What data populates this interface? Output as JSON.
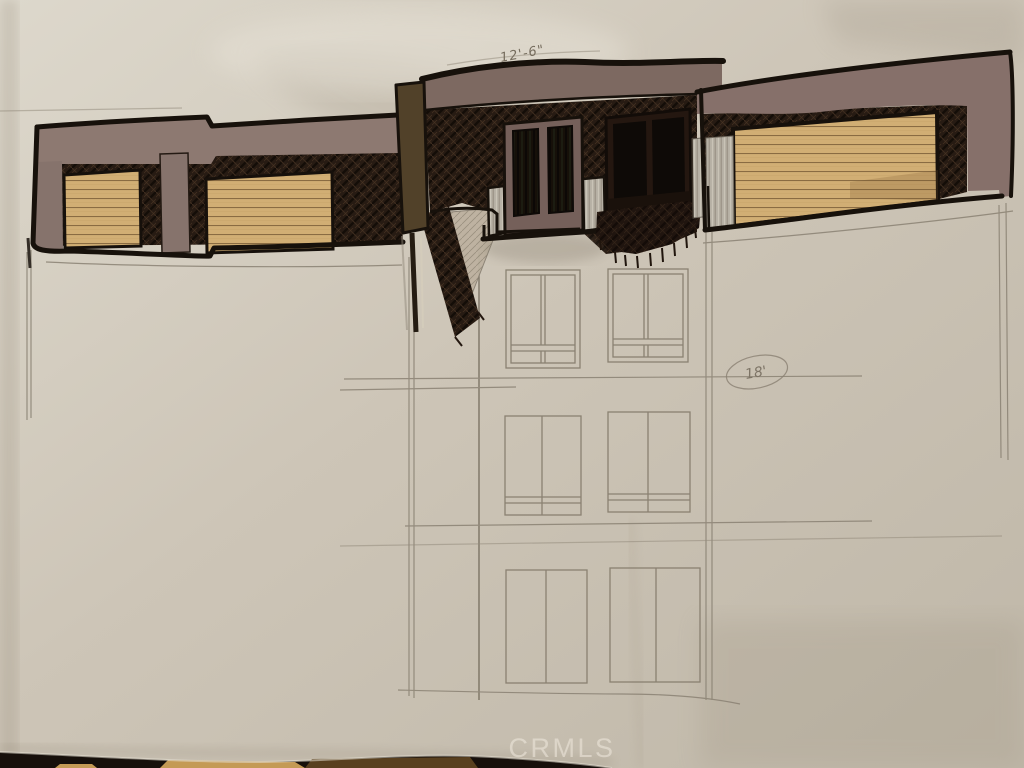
{
  "scene": {
    "label": "architectural elevation sketch",
    "description": "Photograph of a hand-drawn, marker-colored front elevation sketch of a modern house on creased paper; lower floors only pencil-lined"
  },
  "annotations": {
    "roof_dimension": "12'-6\"",
    "circled_dimension": "18'"
  },
  "watermark": {
    "text": "CRMLS"
  },
  "colors": {
    "paper": "#cdc5b7",
    "ink_outline": "#17110b",
    "hatch_dark_brown": "#271b13",
    "mauve_band": "#86736c",
    "fascia_mauve": "#7d6961",
    "tan_siding": "#d1ae74",
    "olive_pillar": "#514129",
    "door_frame_mauve": "#75605a",
    "glass_dark": "#120d09",
    "silver_gray": "#b6b0a4",
    "pencil_gray": "#8a8173",
    "watermark_white": "#f0eade",
    "table_dark": "#17100b",
    "table_tan": "#c49a55"
  }
}
